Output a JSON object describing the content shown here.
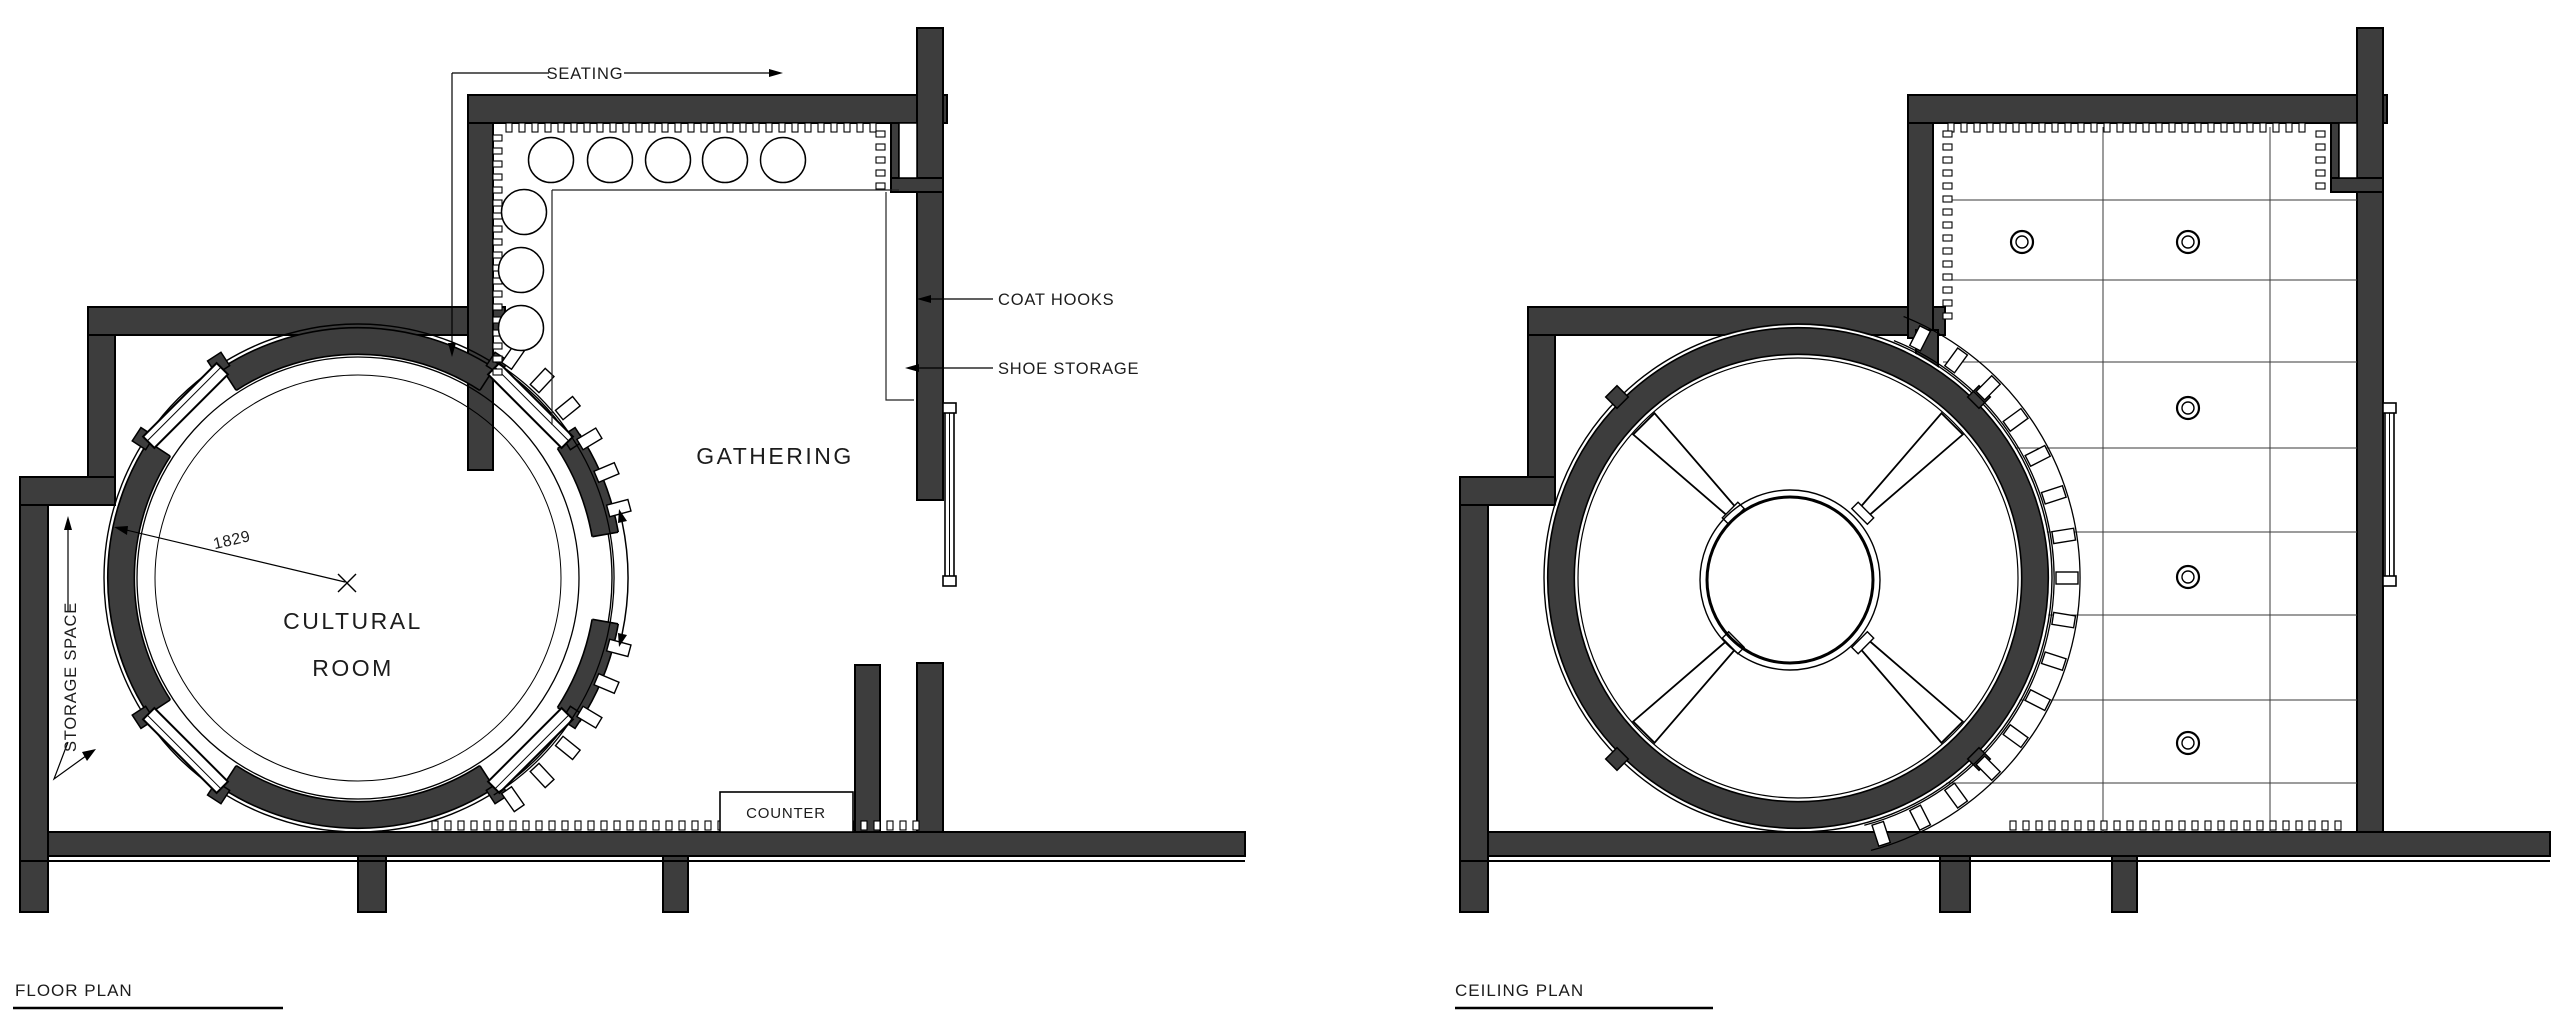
{
  "colors": {
    "wall": "#3d3d3d",
    "line": "#111111",
    "background": "#ffffff"
  },
  "floor_plan": {
    "title": "FLOOR PLAN",
    "room_labels": {
      "cultural_room_line1": "CULTURAL",
      "cultural_room_line2": "ROOM",
      "gathering": "GATHERING"
    },
    "annotations": {
      "seating": "SEATING",
      "coat_hooks": "COAT HOOKS",
      "shoe_storage": "SHOE STORAGE",
      "storage_space": "STORAGE SPACE",
      "counter": "COUNTER",
      "radius_dimension": "1829"
    }
  },
  "ceiling_plan": {
    "title": "CEILING PLAN"
  }
}
